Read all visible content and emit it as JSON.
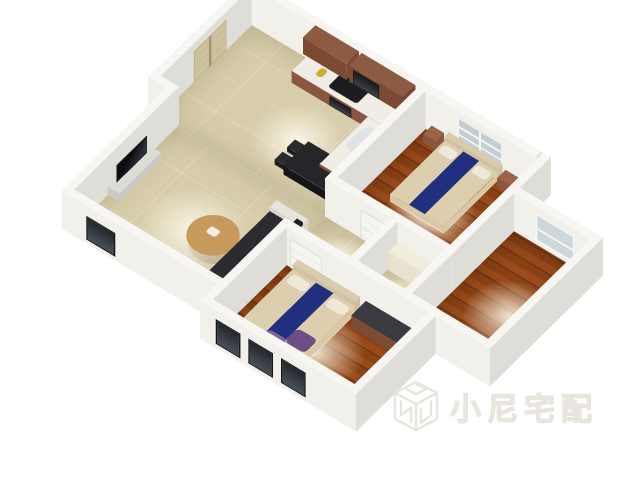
{
  "watermark": {
    "text": "小尼宅配",
    "logo": "cube-n-logo",
    "color": "#e7e5dd"
  },
  "page": {
    "background": "#ffffff"
  },
  "scene": {
    "view": {
      "left": 250,
      "top": 15,
      "scale": 0.92,
      "tiltX": 40,
      "rotZ": 38
    },
    "wall_height": 64,
    "palette": {
      "wall": {
        "s": "#f1f0eb",
        "n": "#e7e6e1",
        "w": "#eceae5",
        "e": "#deddd8",
        "t": "#f7f6f2"
      },
      "tile_floor": "#d8cdab",
      "wood_floor": "#8a4215",
      "accent_bed_runner": "#20307e",
      "cabinet_wood": "#8a5640"
    },
    "floors": [
      {
        "name": "kitchen-dining-floor",
        "type": "tile",
        "x": 10,
        "y": 10,
        "w": 230,
        "h": 165
      },
      {
        "name": "living-floor",
        "type": "tile",
        "x": 35,
        "y": 175,
        "w": 215,
        "h": 180
      },
      {
        "name": "hall-floor",
        "type": "tile",
        "x": 240,
        "y": 175,
        "w": 90,
        "h": 70
      },
      {
        "name": "bath-floor",
        "type": "tile",
        "x": 340,
        "y": 175,
        "w": 65,
        "h": 70
      },
      {
        "name": "bedroom1-floor",
        "type": "wood",
        "x": 250,
        "y": 10,
        "w": 155,
        "h": 155
      },
      {
        "name": "bedroom2-floor",
        "type": "wood",
        "x": 415,
        "y": 65,
        "w": 105,
        "h": 180
      },
      {
        "name": "bedroom3-floor",
        "type": "wood",
        "x": 250,
        "y": 255,
        "w": 195,
        "h": 130
      }
    ],
    "glows": [
      {
        "x": 95,
        "y": 55,
        "w": 110,
        "h": 110
      },
      {
        "x": 75,
        "y": 215,
        "w": 130,
        "h": 130
      },
      {
        "x": 255,
        "y": 180,
        "w": 70,
        "h": 70
      },
      {
        "x": 275,
        "y": 50,
        "w": 110,
        "h": 110
      },
      {
        "x": 430,
        "y": 110,
        "w": 110,
        "h": 110
      },
      {
        "x": 290,
        "y": 275,
        "w": 120,
        "h": 120
      },
      {
        "x": 346,
        "y": 188,
        "w": 55,
        "h": 55
      }
    ],
    "walls": [
      {
        "name": "outer-top-wall",
        "x": 0,
        "y": 0,
        "w": 415,
        "h": 10
      },
      {
        "name": "bed1-bed2-notch-wall",
        "x": 405,
        "y": 0,
        "w": 10,
        "h": 65
      },
      {
        "name": "bedroom2-top-wall",
        "x": 415,
        "y": 55,
        "w": 115,
        "h": 10
      },
      {
        "name": "bedroom2-right-wall",
        "x": 520,
        "y": 55,
        "w": 10,
        "h": 200
      },
      {
        "name": "bedroom2-bottom-wall",
        "x": 415,
        "y": 245,
        "w": 115,
        "h": 10
      },
      {
        "name": "bedroom3-right-wall",
        "x": 445,
        "y": 245,
        "w": 10,
        "h": 150
      },
      {
        "name": "bedroom3-bottom-wall",
        "x": 240,
        "y": 385,
        "w": 215,
        "h": 10
      },
      {
        "name": "bedroom3-left-wall",
        "x": 240,
        "y": 245,
        "w": 10,
        "h": 150
      },
      {
        "name": "living-bottom-wall",
        "x": 25,
        "y": 355,
        "w": 225,
        "h": 10
      },
      {
        "name": "outer-left-wall",
        "x": 0,
        "y": 0,
        "w": 10,
        "h": 180
      },
      {
        "name": "left-step-wall",
        "x": 0,
        "y": 170,
        "w": 35,
        "h": 10
      },
      {
        "name": "living-left-wall",
        "x": 25,
        "y": 180,
        "w": 10,
        "h": 185
      },
      {
        "name": "kitchen-bed1-divider",
        "x": 240,
        "y": 10,
        "w": 10,
        "h": 165
      },
      {
        "name": "hall-top-wall",
        "x": 240,
        "y": 165,
        "w": 175,
        "h": 10
      },
      {
        "name": "hall-bath-divider",
        "x": 330,
        "y": 175,
        "w": 10,
        "h": 80
      },
      {
        "name": "hall-bottom-wall",
        "x": 240,
        "y": 245,
        "w": 215,
        "h": 10
      },
      {
        "name": "bedroom2-left-wall",
        "x": 405,
        "y": 65,
        "w": 10,
        "h": 190
      }
    ],
    "openings": [
      {
        "name": "kitchen-window",
        "cls": "win-dark",
        "dir": "x",
        "x": 186,
        "y": 11,
        "len": 48,
        "z": 12,
        "ht": 40
      },
      {
        "name": "bedroom1-window",
        "cls": "win-white6",
        "dir": "x",
        "x": 295,
        "y": 11,
        "len": 62,
        "z": 10,
        "ht": 44
      },
      {
        "name": "bedroom2-window",
        "cls": "win-white2",
        "dir": "x",
        "x": 445,
        "y": 66,
        "len": 55,
        "z": 8,
        "ht": 46
      },
      {
        "name": "bedroom3-window-1",
        "cls": "win-dark",
        "dir": "x",
        "x": 262,
        "y": 395.8,
        "len": 34,
        "z": 8,
        "ht": 42
      },
      {
        "name": "bedroom3-window-2",
        "cls": "win-dark",
        "dir": "x",
        "x": 307,
        "y": 395.8,
        "len": 34,
        "z": 8,
        "ht": 42
      },
      {
        "name": "bedroom3-window-3",
        "cls": "win-dark",
        "dir": "x",
        "x": 352,
        "y": 395.8,
        "len": 34,
        "z": 8,
        "ht": 42
      },
      {
        "name": "living-window-1",
        "cls": "win-dark",
        "dir": "y",
        "x": 24.2,
        "y": 205,
        "len": 42,
        "z": 8,
        "ht": 40
      },
      {
        "name": "living-window-2",
        "cls": "win-dark",
        "dir": "y",
        "x": 24.2,
        "y": 260,
        "len": 42,
        "z": 8,
        "ht": 40
      },
      {
        "name": "living-window-3",
        "cls": "win-dark",
        "dir": "x",
        "x": 60,
        "y": 365.8,
        "len": 40,
        "z": 8,
        "ht": 40
      },
      {
        "name": "entry-door",
        "cls": "door-beige",
        "dir": "y",
        "x": 10.8,
        "y": 55,
        "len": 58,
        "z": 0,
        "ht": 52
      },
      {
        "name": "bedroom1-door",
        "cls": "door-white",
        "dir": "x",
        "x": 290,
        "y": 175.8,
        "len": 44,
        "z": 0,
        "ht": 50
      },
      {
        "name": "bedroom3-door",
        "cls": "door-white",
        "dir": "x",
        "x": 255,
        "y": 255.8,
        "len": 44,
        "z": 0,
        "ht": 50
      },
      {
        "name": "bedroom2-door",
        "cls": "door-white",
        "dir": "y",
        "x": 404.2,
        "y": 180,
        "len": 44,
        "z": 0,
        "ht": 50
      },
      {
        "name": "bathroom-door",
        "cls": "door-white",
        "dir": "y",
        "x": 329.2,
        "y": 185,
        "len": 40,
        "z": 0,
        "ht": 50
      }
    ],
    "furniture": [
      {
        "kind": "box",
        "name": "kitchen-counter-main",
        "x": 95,
        "y": 10,
        "w": 145,
        "h": 38,
        "ht": 20,
        "c": "#8a5640",
        "ct": "#efede6"
      },
      {
        "kind": "box",
        "name": "kitchen-counter-side",
        "x": 200,
        "y": 48,
        "w": 40,
        "h": 85,
        "ht": 20,
        "c": "#8a5640",
        "ct": "#efede6"
      },
      {
        "kind": "flat",
        "name": "cooktop",
        "x": 140,
        "y": 16,
        "w": 40,
        "h": 26,
        "z": 21,
        "c": "#1d1d1f",
        "r": 4
      },
      {
        "kind": "flat",
        "name": "kitchen-sink",
        "x": 206,
        "y": 58,
        "w": 28,
        "h": 42,
        "z": 21,
        "c": "#dfe3e4",
        "r": 12
      },
      {
        "kind": "flat",
        "name": "bottle",
        "x": 118,
        "y": 24,
        "w": 9,
        "h": 13,
        "z": 21,
        "c": "#c9b12e",
        "r": 4
      },
      {
        "kind": "box",
        "name": "upper-cabinet-left",
        "x": 98,
        "y": 10,
        "w": 60,
        "h": 22,
        "z": 36,
        "ht": 28,
        "c": "#7c4a34",
        "ct": "#8d5a42"
      },
      {
        "kind": "box",
        "name": "upper-cabinet-right",
        "x": 162,
        "y": 10,
        "w": 74,
        "h": 22,
        "z": 36,
        "ht": 28,
        "c": "#7c4a34",
        "ct": "#8d5a42"
      },
      {
        "kind": "vface",
        "name": "range-hood",
        "cls": "glass-dark",
        "dir": "x",
        "x": 168,
        "y": 33,
        "len": 36,
        "z": 38,
        "ht": 24
      },
      {
        "kind": "vface",
        "name": "oven-door",
        "cls": "glass-dark",
        "dir": "x",
        "x": 148,
        "y": 49,
        "len": 30,
        "z": 2,
        "ht": 16
      },
      {
        "kind": "box",
        "name": "dining-table",
        "x": 168,
        "y": 112,
        "w": 58,
        "h": 44,
        "ht": 15,
        "c": "#161616",
        "ct": "#26262a"
      },
      {
        "kind": "box",
        "name": "dining-chair-1",
        "x": 152,
        "y": 115,
        "w": 13,
        "h": 14,
        "ht": 9,
        "c": "#1c1c1e",
        "ct": "#2c2c30"
      },
      {
        "kind": "box",
        "name": "dining-chair-2",
        "x": 152,
        "y": 137,
        "w": 13,
        "h": 14,
        "ht": 9,
        "c": "#1c1c1e",
        "ct": "#2c2c30"
      },
      {
        "kind": "box",
        "name": "dining-chair-3",
        "x": 228,
        "y": 115,
        "w": 12,
        "h": 14,
        "ht": 9,
        "c": "#1c1c1e",
        "ct": "#2c2c30"
      },
      {
        "kind": "box",
        "name": "dining-chair-4",
        "x": 228,
        "y": 137,
        "w": 12,
        "h": 14,
        "ht": 9,
        "c": "#1c1c1e",
        "ct": "#2c2c30"
      },
      {
        "kind": "box",
        "name": "tv-stand",
        "x": 35,
        "y": 222,
        "w": 16,
        "h": 74,
        "ht": 13,
        "c": "#c9c9c4",
        "ct": "#dcdcd7"
      },
      {
        "kind": "vface",
        "name": "tv",
        "cls": "tv-screen",
        "dir": "y",
        "x": 39,
        "y": 232,
        "len": 54,
        "z": 13,
        "ht": 30
      },
      {
        "kind": "box",
        "name": "sofa-seat",
        "x": 196,
        "y": 214,
        "w": 44,
        "h": 118,
        "ht": 15,
        "c": "#202024",
        "ct": "#2b2b30"
      },
      {
        "kind": "box",
        "name": "sofa-back",
        "x": 232,
        "y": 214,
        "w": 8,
        "h": 118,
        "ht": 27,
        "c": "#18181c",
        "ct": "#222226"
      },
      {
        "kind": "box",
        "name": "sofa-armrest-top",
        "x": 196,
        "y": 204,
        "w": 44,
        "h": 12,
        "ht": 22,
        "c": "#d6d4cc",
        "ct": "#e6e4dc"
      },
      {
        "kind": "box",
        "name": "sofa-armrest-bottom",
        "x": 196,
        "y": 330,
        "w": 44,
        "h": 12,
        "ht": 22,
        "c": "#d6d4cc",
        "ct": "#e6e4dc"
      },
      {
        "kind": "disc",
        "name": "coffee-table-shadow",
        "x": 142,
        "y": 256,
        "w": 56,
        "h": 52,
        "z": 1,
        "c": "rgba(100,80,50,0.25)"
      },
      {
        "kind": "disc",
        "name": "coffee-table",
        "x": 138,
        "y": 250,
        "w": 58,
        "h": 58,
        "z": 12,
        "c": "#c79a5c"
      },
      {
        "kind": "flat",
        "name": "coffee-table-item",
        "x": 158,
        "y": 270,
        "w": 13,
        "h": 11,
        "z": 13,
        "c": "#f0efe8",
        "r": 3
      },
      {
        "kind": "box",
        "name": "bedroom3-headboard",
        "x": 266,
        "y": 256,
        "w": 86,
        "h": 9,
        "ht": 22,
        "c": "#cfc2a4",
        "ct": "#d8cbae"
      },
      {
        "kind": "box",
        "name": "bedroom3-mattress",
        "x": 266,
        "y": 265,
        "w": 86,
        "h": 108,
        "ht": 14,
        "c": "#d8c8a6",
        "ct": "#ddcfae"
      },
      {
        "kind": "flat",
        "name": "bedroom3-runner",
        "x": 298,
        "y": 265,
        "w": 24,
        "h": 108,
        "z": 15,
        "c": "#20307e"
      },
      {
        "kind": "flat",
        "name": "bedroom3-pillow-left",
        "x": 271,
        "y": 270,
        "w": 25,
        "h": 15,
        "z": 15,
        "c": "#efe9da",
        "r": 5
      },
      {
        "kind": "flat",
        "name": "bedroom3-pillow-right",
        "x": 325,
        "y": 270,
        "w": 25,
        "h": 15,
        "z": 15,
        "c": "#efe9da",
        "r": 5
      },
      {
        "kind": "flat",
        "name": "bedroom3-blanket-1",
        "x": 322,
        "y": 328,
        "w": 28,
        "h": 24,
        "z": 15,
        "c": "#6b4e86",
        "r": 6
      },
      {
        "kind": "flat",
        "name": "bedroom3-blanket-2",
        "x": 298,
        "y": 348,
        "w": 26,
        "h": 18,
        "z": 15,
        "c": "#83619c",
        "r": 6
      },
      {
        "kind": "flat",
        "name": "bedroom3-throw",
        "x": 276,
        "y": 356,
        "w": 30,
        "h": 12,
        "z": 15,
        "c": "#f2ecdf",
        "r": 5
      },
      {
        "kind": "box",
        "name": "bedroom3-dresser",
        "x": 360,
        "y": 256,
        "w": 72,
        "h": 26,
        "ht": 21,
        "c": "#7c4c34",
        "ct": "#3a3a40"
      },
      {
        "kind": "box",
        "name": "bathroom-cabinet",
        "x": 342,
        "y": 177,
        "w": 60,
        "h": 16,
        "ht": 32,
        "c": "#e9e2cf",
        "ct": "#f2ecdc"
      },
      {
        "kind": "box",
        "name": "toilet",
        "x": 384,
        "y": 214,
        "w": 19,
        "h": 24,
        "ht": 13,
        "c": "#f3f3f0",
        "ct": "#fafaf8"
      },
      {
        "kind": "box",
        "name": "bedroom1-headboard",
        "x": 283,
        "y": 11,
        "w": 74,
        "h": 8,
        "ht": 20,
        "c": "#cfc2a4",
        "ct": "#d8cbae"
      },
      {
        "kind": "box",
        "name": "bedroom1-mattress",
        "x": 283,
        "y": 19,
        "w": 74,
        "h": 96,
        "ht": 13,
        "c": "#d8c8a6",
        "ct": "#ddcfae"
      },
      {
        "kind": "flat",
        "name": "bedroom1-runner",
        "x": 309,
        "y": 19,
        "w": 22,
        "h": 96,
        "z": 14,
        "c": "#20307e"
      },
      {
        "kind": "flat",
        "name": "bedroom1-pillow-left",
        "x": 287,
        "y": 24,
        "w": 20,
        "h": 13,
        "z": 14,
        "c": "#efe9da",
        "r": 4
      },
      {
        "kind": "flat",
        "name": "bedroom1-pillow-right",
        "x": 333,
        "y": 24,
        "w": 20,
        "h": 13,
        "z": 14,
        "c": "#efe9da",
        "r": 4
      },
      {
        "kind": "box",
        "name": "bedroom1-nightstand-left",
        "x": 260,
        "y": 12,
        "w": 17,
        "h": 15,
        "ht": 15,
        "c": "#8a5640",
        "ct": "#9a6448"
      },
      {
        "kind": "box",
        "name": "bedroom1-nightstand-right",
        "x": 362,
        "y": 12,
        "w": 17,
        "h": 15,
        "ht": 15,
        "c": "#8a5640",
        "ct": "#9a6448"
      }
    ]
  }
}
